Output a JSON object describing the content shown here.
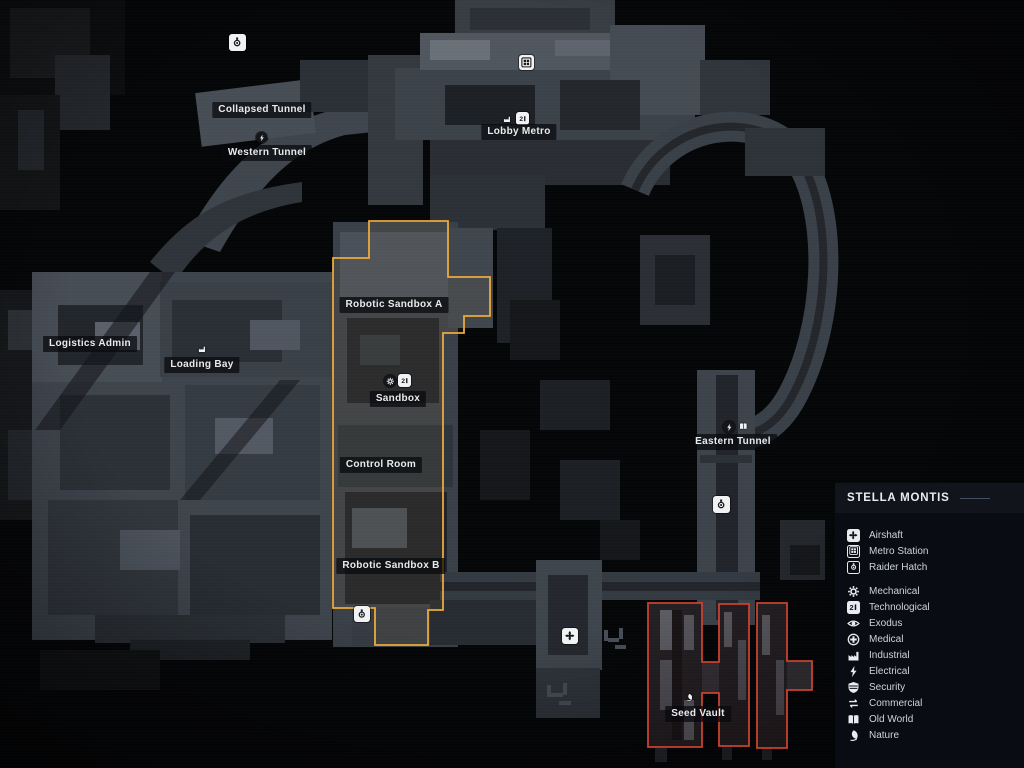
{
  "map": {
    "labels": [
      {
        "text": "Collapsed Tunnel"
      },
      {
        "text": "Western Tunnel"
      },
      {
        "text": "Lobby Metro"
      },
      {
        "text": "Logistics Admin"
      },
      {
        "text": "Loading Bay"
      },
      {
        "text": "Robotic Sandbox A"
      },
      {
        "text": "Sandbox"
      },
      {
        "text": "Control Room"
      },
      {
        "text": "Robotic Sandbox B"
      },
      {
        "text": "Eastern Tunnel"
      },
      {
        "text": "Seed Vault"
      }
    ],
    "markers": [
      {
        "icon": "raider-hatch-icon"
      },
      {
        "icon": "metro-station-icon"
      },
      {
        "icon": "lightning-icon"
      },
      {
        "icon": "factory-icon"
      },
      {
        "icon": "chip-icon"
      },
      {
        "icon": "factory-icon"
      },
      {
        "icon": "gear-icon"
      },
      {
        "icon": "chip-icon"
      },
      {
        "icon": "lightning-icon"
      },
      {
        "icon": "book-icon"
      },
      {
        "icon": "raider-hatch-icon"
      },
      {
        "icon": "airshaft-fan-icon"
      },
      {
        "icon": "raider-hatch-icon"
      },
      {
        "icon": "leaf-icon"
      }
    ],
    "regions": [
      {
        "name": "robotic-sandbox-highlight",
        "color": "#ECA93C"
      },
      {
        "name": "seed-vault-highlight",
        "color": "#C8402F"
      }
    ]
  },
  "legend": {
    "title": "STELLA MONTIS",
    "location_items": [
      {
        "icon": "airshaft-fan-icon",
        "label": "Airshaft"
      },
      {
        "icon": "metro-station-icon",
        "label": "Metro Station"
      },
      {
        "icon": "raider-hatch-icon",
        "label": "Raider Hatch"
      }
    ],
    "category_items": [
      {
        "icon": "gear-icon",
        "label": "Mechanical"
      },
      {
        "icon": "chip-icon",
        "label": "Technological"
      },
      {
        "icon": "eye-icon",
        "label": "Exodus"
      },
      {
        "icon": "medical-cross-icon",
        "label": "Medical"
      },
      {
        "icon": "factory-icon",
        "label": "Industrial"
      },
      {
        "icon": "lightning-icon",
        "label": "Electrical"
      },
      {
        "icon": "shield-icon",
        "label": "Security"
      },
      {
        "icon": "commerce-arrows-icon",
        "label": "Commercial"
      },
      {
        "icon": "book-icon",
        "label": "Old World"
      },
      {
        "icon": "leaf-icon",
        "label": "Nature"
      }
    ]
  },
  "colors": {
    "highlight_yellow": "#ECA93C",
    "highlight_red": "#C8402F",
    "panel_background": "#0A0C14"
  }
}
